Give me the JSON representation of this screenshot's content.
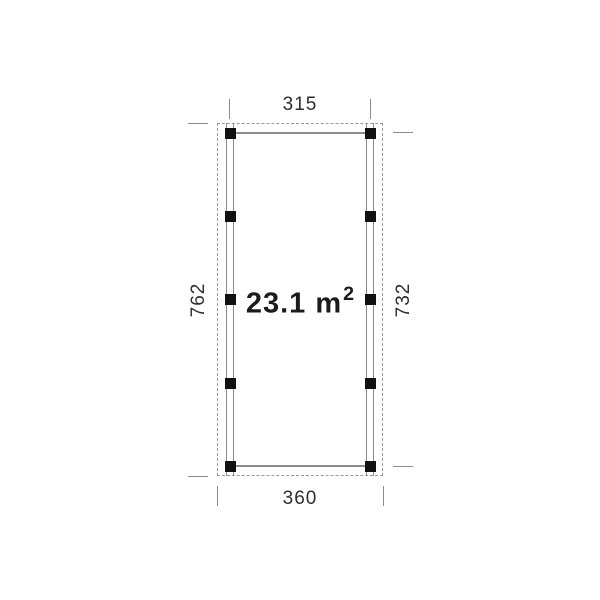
{
  "plan": {
    "area_label": {
      "main": "23.1 m",
      "sup": "2",
      "full": "23.1 m²"
    },
    "dimensions": {
      "top": "315",
      "bottom": "360",
      "left": "762",
      "right": "732"
    }
  },
  "colors": {
    "background": "#ffffff",
    "solid_line": "#8c8c8c",
    "dashed_line": "#999999",
    "post": "#111111",
    "dimension_text": "#2e2e2e",
    "area_text": "#1b1b1b"
  }
}
